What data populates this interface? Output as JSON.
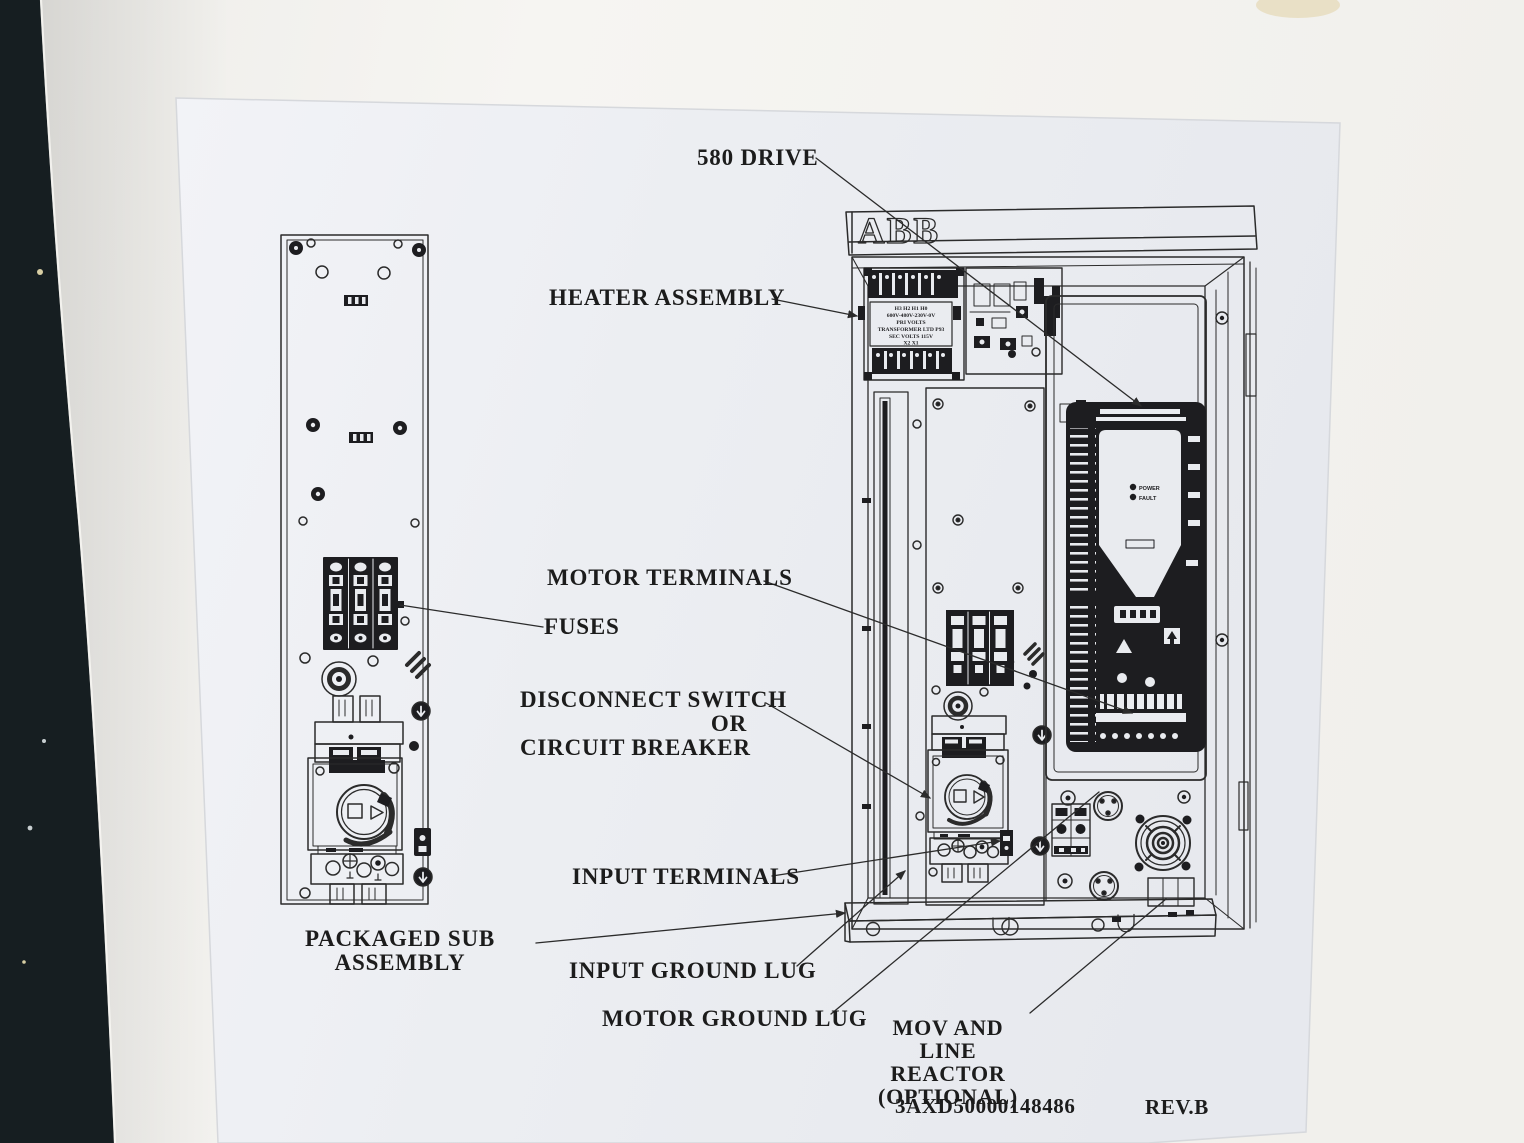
{
  "photo": {
    "wall_color": "#f4f3ef",
    "door_edge_color": "#161e21",
    "paper_color": "#edeff3",
    "ink_color": "#2b2b2b"
  },
  "sheet": {
    "brand_logo": "ABB",
    "doc_number": "3AXD50000148486",
    "revision": "REV.B"
  },
  "callouts": {
    "drive": "580 DRIVE",
    "heater": "HEATER ASSEMBLY",
    "motor_terminals": "MOTOR TERMINALS",
    "fuses": "FUSES",
    "disconnect_line1": "DISCONNECT SWITCH",
    "disconnect_line2": "OR",
    "disconnect_line3": "CIRCUIT BREAKER",
    "input_terminals": "INPUT TERMINALS",
    "packaged_line1": "PACKAGED SUB",
    "packaged_line2": "ASSEMBLY",
    "input_ground": "INPUT GROUND LUG",
    "motor_ground": "MOTOR GROUND LUG",
    "mov_line1": "MOV AND",
    "mov_line2": "LINE REACTOR",
    "mov_line3": "(OPTIONAL)"
  },
  "drive_module": {
    "led_power": "POWER",
    "led_fault": "FAULT"
  },
  "transformer_label": [
    "H3 H2 H1 H0",
    "600V-480V-230V-0V",
    "PRI VOLTS",
    "TRANSFORMER LTD P93",
    "SEC VOLTS 115V",
    "X2  X1"
  ]
}
